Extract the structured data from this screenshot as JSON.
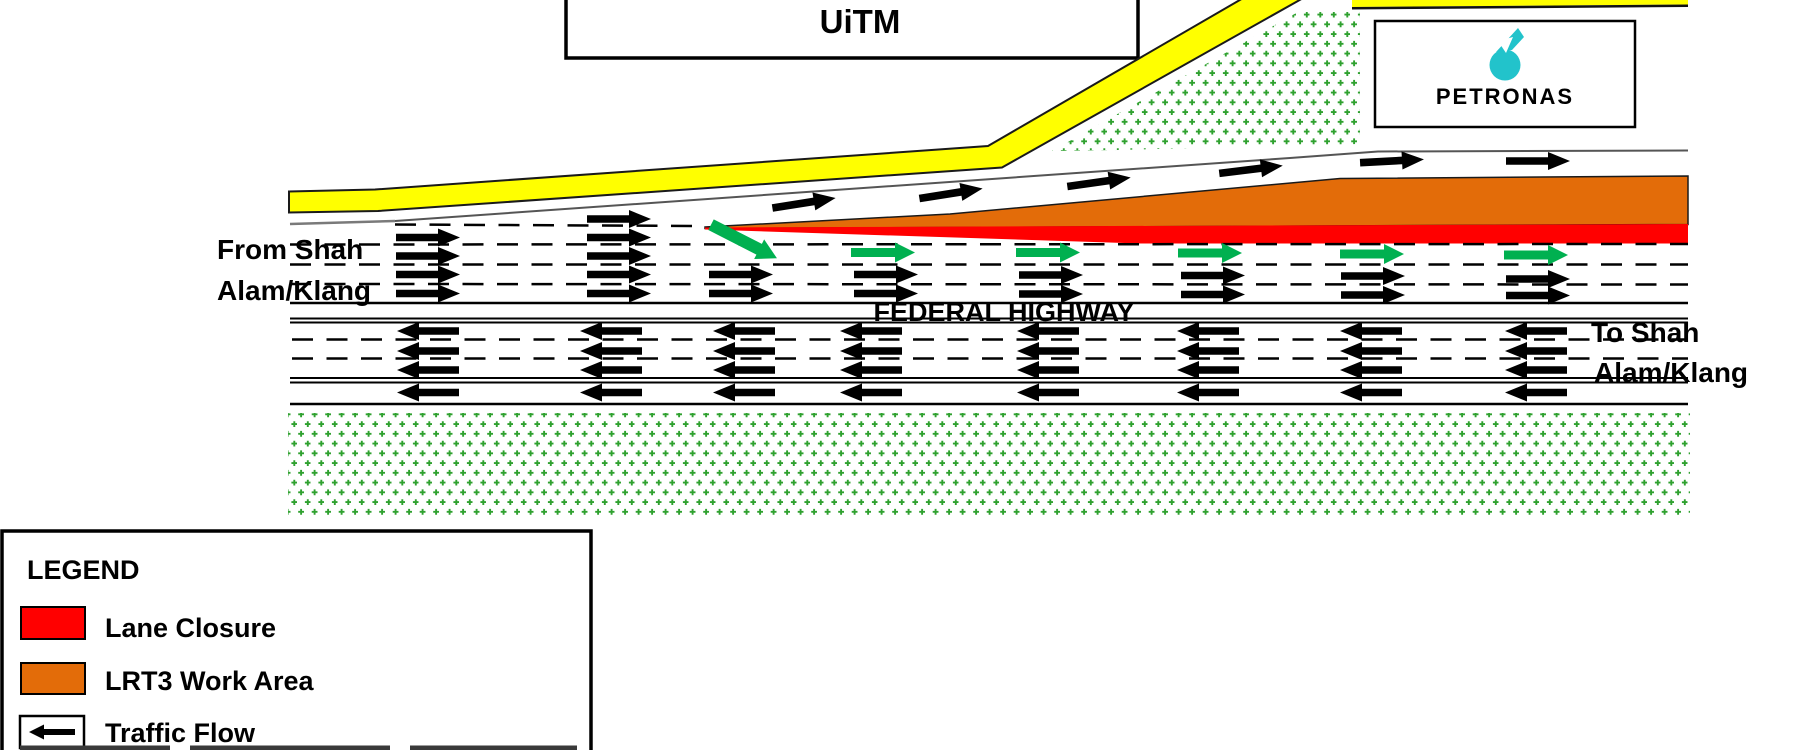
{
  "labels": {
    "uitm": "UiTM",
    "petronas": "PETRONAS",
    "federal_highway": "FEDERAL HIGHWAY",
    "from_shah_line1": "From Shah",
    "from_shah_line2": "Alam/Klang",
    "to_shah_line1": "To Shah",
    "to_shah_line2": "Alam/Klang"
  },
  "legend": {
    "title": "LEGEND",
    "items": [
      {
        "label": "Lane Closure",
        "color": "#FF0000"
      },
      {
        "label": "LRT3 Work Area",
        "color": "#E36C09"
      },
      {
        "label": "Traffic Flow",
        "symbol": "left-arrow"
      }
    ]
  },
  "colors": {
    "lane_closure_red": "#FF0000",
    "work_area_orange": "#E36C09",
    "road_edge_yellow": "#FFFF00",
    "open_lane_arrow_green": "#00B050",
    "vegetation_green": "#2FA12F",
    "petronas_teal": "#22C3CB",
    "traffic_arrow_black": "#000000"
  }
}
